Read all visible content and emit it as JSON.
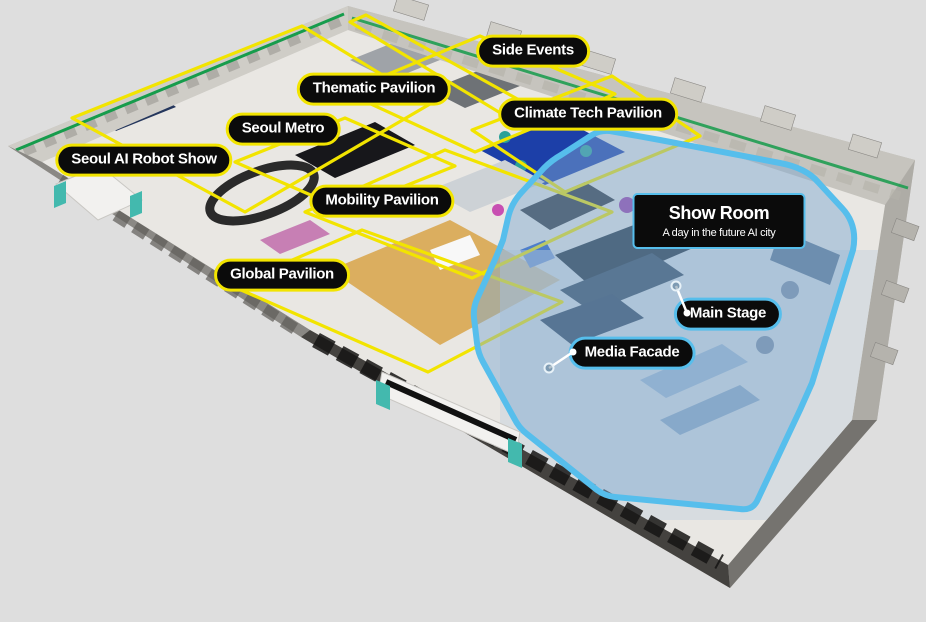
{
  "map": {
    "colors": {
      "background": "#DEDEDE",
      "zone_outline": "#F2E400",
      "highlight": "#56BEEC",
      "label_bg": "#0B0B0B",
      "label_text": "#FFFFFF",
      "wall_green": "#169C4C"
    },
    "zones": [
      {
        "label": "Side Events",
        "outline": "yellow"
      },
      {
        "label": "Thematic Pavilion",
        "outline": "yellow"
      },
      {
        "label": "Seoul Metro",
        "outline": "yellow"
      },
      {
        "label": "Climate Tech Pavilion",
        "outline": "yellow"
      },
      {
        "label": "Seoul AI Robot Show",
        "outline": "yellow"
      },
      {
        "label": "Mobility Pavilion",
        "outline": "yellow"
      },
      {
        "label": "Global Pavilion",
        "outline": "yellow"
      },
      {
        "label": "Main Stage",
        "outline": "blue"
      },
      {
        "label": "Media Facade",
        "outline": "blue"
      }
    ],
    "show_room": {
      "title": "Show Room",
      "subtitle": "A day in the future AI city"
    }
  }
}
